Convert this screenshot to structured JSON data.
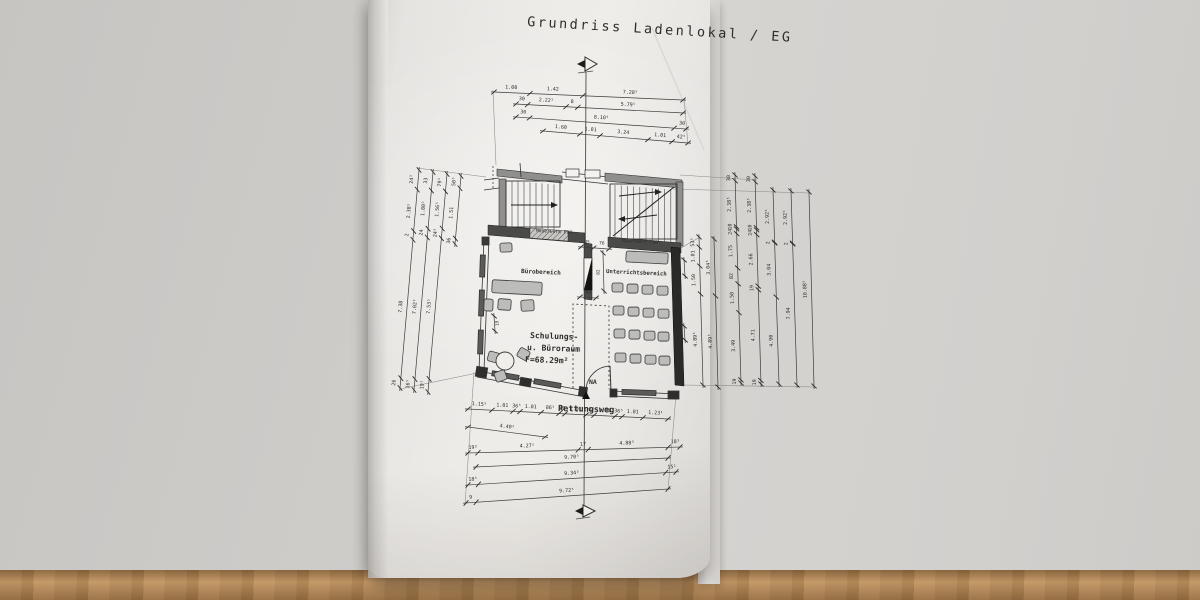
{
  "title": "Grundriss Ladenlokal / EG",
  "plan": {
    "labels": {
      "mauerwerk_left": "Mauerwerk F90",
      "mauerwerk_right": "Mauerwerk F90",
      "buero": "Bürobereich",
      "unterricht": "Unterrichtsbereich",
      "schulung1": "Schulungs-",
      "schulung2": "u. Büroraum",
      "schulung3": "F=68.29m²",
      "na": "NA",
      "rettungsweg": "Rettungsweg"
    },
    "seats": {
      "w": 11,
      "h": 9,
      "rows": [
        {
          "y": 283,
          "xs": [
            612,
            627,
            642,
            657
          ]
        },
        {
          "y": 306,
          "xs": [
            613,
            628,
            643,
            658
          ]
        },
        {
          "y": 329,
          "xs": [
            614,
            629,
            644,
            658
          ]
        },
        {
          "y": 353,
          "xs": [
            615,
            630,
            645,
            659
          ]
        }
      ]
    },
    "chairs": [
      {
        "x": 500,
        "y": 243,
        "w": 12,
        "h": 9,
        "r": -2
      },
      {
        "x": 492,
        "y": 281,
        "w": 50,
        "h": 13,
        "r": 3,
        "type": "desk"
      },
      {
        "x": 484,
        "y": 299,
        "w": 9,
        "h": 12,
        "r": 2
      },
      {
        "x": 498,
        "y": 299,
        "w": 13,
        "h": 11,
        "r": 4
      },
      {
        "x": 521,
        "y": 300,
        "w": 13,
        "h": 11,
        "r": -3
      },
      {
        "x": 488,
        "y": 352,
        "w": 11,
        "h": 10,
        "r": 15
      },
      {
        "x": 495,
        "y": 371,
        "w": 11,
        "h": 10,
        "r": -20
      },
      {
        "x": 518,
        "y": 349,
        "w": 11,
        "h": 10,
        "r": 30
      },
      {
        "x": 626,
        "y": 252,
        "w": 42,
        "h": 11,
        "r": 3,
        "type": "board"
      }
    ],
    "round_table": {
      "cx": 505,
      "cy": 361,
      "r": 9
    }
  },
  "colors": {
    "line": "#3a3a38",
    "wall": "#3f3f3d",
    "wallDark": "#1f1f1d",
    "grey": "#8f8f8d",
    "furniture": "#bcbcba"
  },
  "dimensions": [
    {
      "n": "top-1",
      "x1": 494,
      "y1": 92,
      "x2": 683,
      "y2": 100,
      "ticks": [
        0,
        0.19,
        0.47,
        1
      ],
      "labels": [
        {
          "t": 0.09,
          "s": "1.00",
          "o": 4
        },
        {
          "t": 0.31,
          "s": "1.42",
          "o": 4
        },
        {
          "t": 0.72,
          "s": "7.28⁵",
          "o": 4
        }
      ]
    },
    {
      "n": "top-2",
      "x1": 516,
      "y1": 104,
      "x2": 683,
      "y2": 113,
      "ticks": [
        0,
        0.07,
        0.3,
        0.37,
        1
      ],
      "labels": [
        {
          "t": 0.033,
          "s": "30",
          "o": 4
        },
        {
          "t": 0.18,
          "s": "2.22⁵",
          "o": 4
        },
        {
          "t": 0.335,
          "s": "8",
          "o": 4
        },
        {
          "t": 0.67,
          "s": "5.79⁵",
          "o": 4
        }
      ]
    },
    {
      "n": "top-3",
      "x1": 516,
      "y1": 117,
      "x2": 686,
      "y2": 129,
      "ticks": [
        0,
        0.08,
        0.93,
        1
      ],
      "labels": [
        {
          "t": 0.04,
          "s": "30",
          "o": 4
        },
        {
          "t": 0.5,
          "s": "8.10⁵",
          "o": 4
        },
        {
          "t": 0.975,
          "s": "30",
          "o": 4
        }
      ]
    },
    {
      "n": "top-4",
      "x1": 543,
      "y1": 131,
      "x2": 688,
      "y2": 143,
      "ticks": [
        0,
        0.255,
        0.393,
        0.724,
        0.89,
        1
      ],
      "labels": [
        {
          "t": 0.12,
          "s": "1.60",
          "o": 4
        },
        {
          "t": 0.325,
          "s": "1.01",
          "o": 4
        },
        {
          "t": 0.55,
          "s": "3.24",
          "o": 4
        },
        {
          "t": 0.805,
          "s": "1.01",
          "o": 4
        },
        {
          "t": 0.95,
          "s": "42⁵",
          "o": 4
        }
      ]
    },
    {
      "n": "bot-1",
      "x1": 468,
      "y1": 409,
      "x2": 668,
      "y2": 419,
      "ticks": [
        0,
        0.12,
        0.225,
        0.26,
        0.365,
        0.455,
        0.485,
        0.59,
        0.63,
        0.735,
        0.77,
        0.875,
        1
      ],
      "labels": [
        {
          "t": 0.055,
          "s": "1.15⁵",
          "o": 4
        },
        {
          "t": 0.17,
          "s": "1.01",
          "o": 4
        },
        {
          "t": 0.242,
          "s": "36⁵",
          "o": 4
        },
        {
          "t": 0.312,
          "s": "1.01",
          "o": 4
        },
        {
          "t": 0.41,
          "s": "86⁵",
          "o": 4
        },
        {
          "t": 0.47,
          "s": "30",
          "o": 4
        },
        {
          "t": 0.537,
          "s": "1.01",
          "o": 4
        },
        {
          "t": 0.61,
          "s": "42",
          "o": 4
        },
        {
          "t": 0.682,
          "s": "1.01",
          "o": 4
        },
        {
          "t": 0.752,
          "s": "36⁵",
          "o": 4
        },
        {
          "t": 0.822,
          "s": "1.01",
          "o": 4
        },
        {
          "t": 0.937,
          "s": "1.23¹",
          "o": 4
        }
      ]
    },
    {
      "n": "bot-2",
      "x1": 468,
      "y1": 427,
      "x2": 545,
      "y2": 437,
      "ticks": [
        0,
        1
      ],
      "labels": [
        {
          "t": 0.5,
          "s": "4.40⁵",
          "o": 4
        }
      ]
    },
    {
      "n": "bot-3",
      "x1": 468,
      "y1": 453,
      "x2": 680,
      "y2": 447,
      "ticks": [
        0,
        0.047,
        0.52,
        0.567,
        0.944,
        1
      ],
      "labels": [
        {
          "t": 0.024,
          "s": "19²",
          "o": 4
        },
        {
          "t": 0.28,
          "s": "4.27⁵",
          "o": 4
        },
        {
          "t": 0.543,
          "s": "17",
          "o": 4
        },
        {
          "t": 0.75,
          "s": "4.88³",
          "o": 4
        },
        {
          "t": 0.978,
          "s": "18³",
          "o": 4
        }
      ]
    },
    {
      "n": "bot-4",
      "x1": 476,
      "y1": 467,
      "x2": 668,
      "y2": 458,
      "ticks": [
        0,
        1
      ],
      "labels": [
        {
          "t": 0.5,
          "s": "9.70⁵",
          "o": 4
        }
      ]
    },
    {
      "n": "bot-5",
      "x1": 468,
      "y1": 485,
      "x2": 676,
      "y2": 472,
      "ticks": [
        0,
        0.05,
        0.95,
        1
      ],
      "labels": [
        {
          "t": 0.025,
          "s": "18⁵",
          "o": 4
        },
        {
          "t": 0.5,
          "s": "9.34³",
          "o": 4
        },
        {
          "t": 0.982,
          "s": "15¹",
          "o": 4
        }
      ]
    },
    {
      "n": "bot-6",
      "x1": 466,
      "y1": 503,
      "x2": 668,
      "y2": 489,
      "ticks": [
        0,
        0.05,
        1
      ],
      "labels": [
        {
          "t": 0.025,
          "s": "9",
          "o": 4
        },
        {
          "t": 0.5,
          "s": "9.72⁵",
          "o": 4
        }
      ]
    },
    {
      "n": "left-1",
      "v": true,
      "x1": 419,
      "y1": 170,
      "x2": 400,
      "y2": 388,
      "ticks": [
        0,
        0.09,
        0.28,
        0.32,
        0.955,
        1
      ],
      "labels": [
        {
          "t": 0.045,
          "s": "24³",
          "o": -5
        },
        {
          "t": 0.19,
          "s": "2.38⁵",
          "o": -5
        },
        {
          "t": 0.3,
          "s": "2",
          "o": -5
        },
        {
          "t": 0.63,
          "s": "7.38",
          "o": -5
        },
        {
          "t": 0.978,
          "s": "26",
          "o": -5
        }
      ]
    },
    {
      "n": "left-2",
      "v": true,
      "x1": 433,
      "y1": 172,
      "x2": 414,
      "y2": 390,
      "ticks": [
        0,
        0.085,
        0.26,
        0.3,
        0.95,
        1
      ],
      "labels": [
        {
          "t": 0.042,
          "s": "33",
          "o": -5
        },
        {
          "t": 0.17,
          "s": "1.80⁵",
          "o": -5
        },
        {
          "t": 0.28,
          "s": "24",
          "o": -5
        },
        {
          "t": 0.62,
          "s": "7.02³",
          "o": -5
        },
        {
          "t": 0.975,
          "s": "16⁵",
          "o": -5
        }
      ]
    },
    {
      "n": "left-3",
      "v": true,
      "x1": 447,
      "y1": 174,
      "x2": 428,
      "y2": 392,
      "ticks": [
        0,
        0.08,
        0.25,
        0.295,
        0.94,
        1
      ],
      "labels": [
        {
          "t": 0.04,
          "s": "79⁵",
          "o": -5
        },
        {
          "t": 0.165,
          "s": "1.56⁵",
          "o": -5
        },
        {
          "t": 0.272,
          "s": "24⁵",
          "o": -5
        },
        {
          "t": 0.61,
          "s": "7.53⁵",
          "o": -5
        },
        {
          "t": 0.97,
          "s": "19¹",
          "o": -5
        }
      ]
    },
    {
      "n": "left-4",
      "v": true,
      "x1": 461,
      "y1": 176,
      "x2": 455,
      "y2": 244,
      "ticks": [
        0,
        0.18,
        0.92,
        1
      ],
      "labels": [
        {
          "t": 0.09,
          "s": "50⁵",
          "o": -5
        },
        {
          "t": 0.55,
          "s": "1.51",
          "o": -5
        },
        {
          "t": 0.96,
          "s": "36",
          "o": -5
        }
      ]
    },
    {
      "n": "right-1",
      "v": true,
      "x1": 699,
      "y1": 237,
      "x2": 703,
      "y2": 385,
      "ticks": [
        0,
        0.068,
        0.196,
        0.385,
        1
      ],
      "labels": [
        {
          "t": 0.034,
          "s": "53⁵",
          "o": -5
        },
        {
          "t": 0.13,
          "s": "1.01",
          "o": -5
        },
        {
          "t": 0.29,
          "s": "1.50",
          "o": -5
        },
        {
          "t": 0.69,
          "s": "4.89⁵",
          "o": -5
        }
      ]
    },
    {
      "n": "right-2",
      "v": true,
      "x1": 714,
      "y1": 239,
      "x2": 718,
      "y2": 387,
      "ticks": [
        0,
        0.385,
        1
      ],
      "labels": [
        {
          "t": 0.19,
          "s": "3.04⁵",
          "o": -5
        },
        {
          "t": 0.69,
          "s": "4.89⁵",
          "o": -5
        }
      ]
    },
    {
      "n": "right-3",
      "v": true,
      "x1": 735,
      "y1": 175,
      "x2": 741,
      "y2": 383,
      "ticks": [
        0,
        0.028,
        0.249,
        0.259,
        0.282,
        0.447,
        0.523,
        0.662,
        0.985,
        1
      ],
      "labels": [
        {
          "t": 0.014,
          "s": "30",
          "o": -5
        },
        {
          "t": 0.14,
          "s": "2.38⁵",
          "o": -5
        },
        {
          "t": 0.247,
          "s": "10",
          "o": -5
        },
        {
          "t": 0.272,
          "s": "24",
          "o": -5
        },
        {
          "t": 0.365,
          "s": "1.75",
          "o": -5
        },
        {
          "t": 0.485,
          "s": "82",
          "o": -5
        },
        {
          "t": 0.59,
          "s": "1.50",
          "o": -5
        },
        {
          "t": 0.82,
          "s": "3.49",
          "o": -5
        },
        {
          "t": 0.992,
          "s": "19",
          "o": -5
        }
      ]
    },
    {
      "n": "right-4",
      "v": true,
      "x1": 755,
      "y1": 176,
      "x2": 761,
      "y2": 384,
      "ticks": [
        0,
        0.028,
        0.249,
        0.259,
        0.282,
        0.529,
        0.547,
        0.983,
        1
      ],
      "labels": [
        {
          "t": 0.014,
          "s": "30",
          "o": -5
        },
        {
          "t": 0.14,
          "s": "2.38⁵",
          "o": -5
        },
        {
          "t": 0.247,
          "s": "10",
          "o": -5
        },
        {
          "t": 0.272,
          "s": "24",
          "o": -5
        },
        {
          "t": 0.4,
          "s": "2.66",
          "o": -5
        },
        {
          "t": 0.538,
          "s": "19",
          "o": -5
        },
        {
          "t": 0.765,
          "s": "4.71",
          "o": -5
        },
        {
          "t": 0.991,
          "s": "19",
          "o": -5
        }
      ]
    },
    {
      "n": "right-5",
      "v": true,
      "x1": 773,
      "y1": 190,
      "x2": 779,
      "y2": 384,
      "ticks": [
        0,
        0.269,
        0.273,
        0.552,
        1
      ],
      "labels": [
        {
          "t": 0.135,
          "s": "2.92⁵",
          "o": -5
        },
        {
          "t": 0.271,
          "s": "2",
          "o": -5
        },
        {
          "t": 0.41,
          "s": "3.04",
          "o": -5
        },
        {
          "t": 0.776,
          "s": "4.90",
          "o": -5
        }
      ]
    },
    {
      "n": "right-6",
      "v": true,
      "x1": 791,
      "y1": 191,
      "x2": 797,
      "y2": 385,
      "ticks": [
        0,
        0.269,
        0.273,
        1
      ],
      "labels": [
        {
          "t": 0.135,
          "s": "2.92⁵",
          "o": -5
        },
        {
          "t": 0.271,
          "s": "2",
          "o": -5
        },
        {
          "t": 0.63,
          "s": "7.94",
          "o": -5
        }
      ]
    },
    {
      "n": "right-7",
      "v": true,
      "x1": 809,
      "y1": 192,
      "x2": 814,
      "y2": 386,
      "ticks": [
        0,
        1
      ],
      "labels": [
        {
          "t": 0.5,
          "s": "10.88⁵",
          "o": -5
        }
      ]
    },
    {
      "n": "wall-top-45-76",
      "x1": 581,
      "y1": 247,
      "x2": 609,
      "y2": 249,
      "fs": 4.5,
      "ticks": [
        0,
        0.45,
        1
      ],
      "labels": [
        {
          "t": 0.2,
          "s": "45",
          "o": 4
        },
        {
          "t": 0.73,
          "s": "76",
          "o": 4
        }
      ]
    },
    {
      "n": "wall-82",
      "v": true,
      "x1": 603,
      "y1": 253,
      "x2": 604,
      "y2": 291,
      "fs": 4.5,
      "ticks": [
        0,
        1
      ],
      "labels": [
        {
          "t": 0.5,
          "s": "82",
          "o": -4
        }
      ]
    },
    {
      "n": "wall-45b",
      "x1": 580,
      "y1": 297,
      "x2": 596,
      "y2": 298,
      "fs": 4.5,
      "ticks": [
        0,
        1
      ],
      "labels": [
        {
          "t": 0.5,
          "s": "45",
          "o": 4
        }
      ]
    },
    {
      "n": "wall-19r",
      "v": true,
      "x1": 684,
      "y1": 260,
      "x2": 685,
      "y2": 276,
      "fs": 4.5,
      "ticks": [
        0,
        1
      ],
      "labels": [
        {
          "t": 0.5,
          "s": "19",
          "o": -4
        }
      ]
    },
    {
      "n": "wall-11r",
      "v": true,
      "x1": 684,
      "y1": 326,
      "x2": 685,
      "y2": 340,
      "fs": 4.5,
      "ticks": [
        0,
        1
      ],
      "labels": [
        {
          "t": 0.5,
          "s": "11",
          "o": -4
        }
      ]
    },
    {
      "n": "wall-19l",
      "v": true,
      "x1": 494,
      "y1": 316,
      "x2": 495,
      "y2": 331,
      "fs": 4.5,
      "ticks": [
        0,
        1
      ],
      "labels": [
        {
          "t": 0.5,
          "s": "19",
          "o": 4
        }
      ]
    }
  ]
}
